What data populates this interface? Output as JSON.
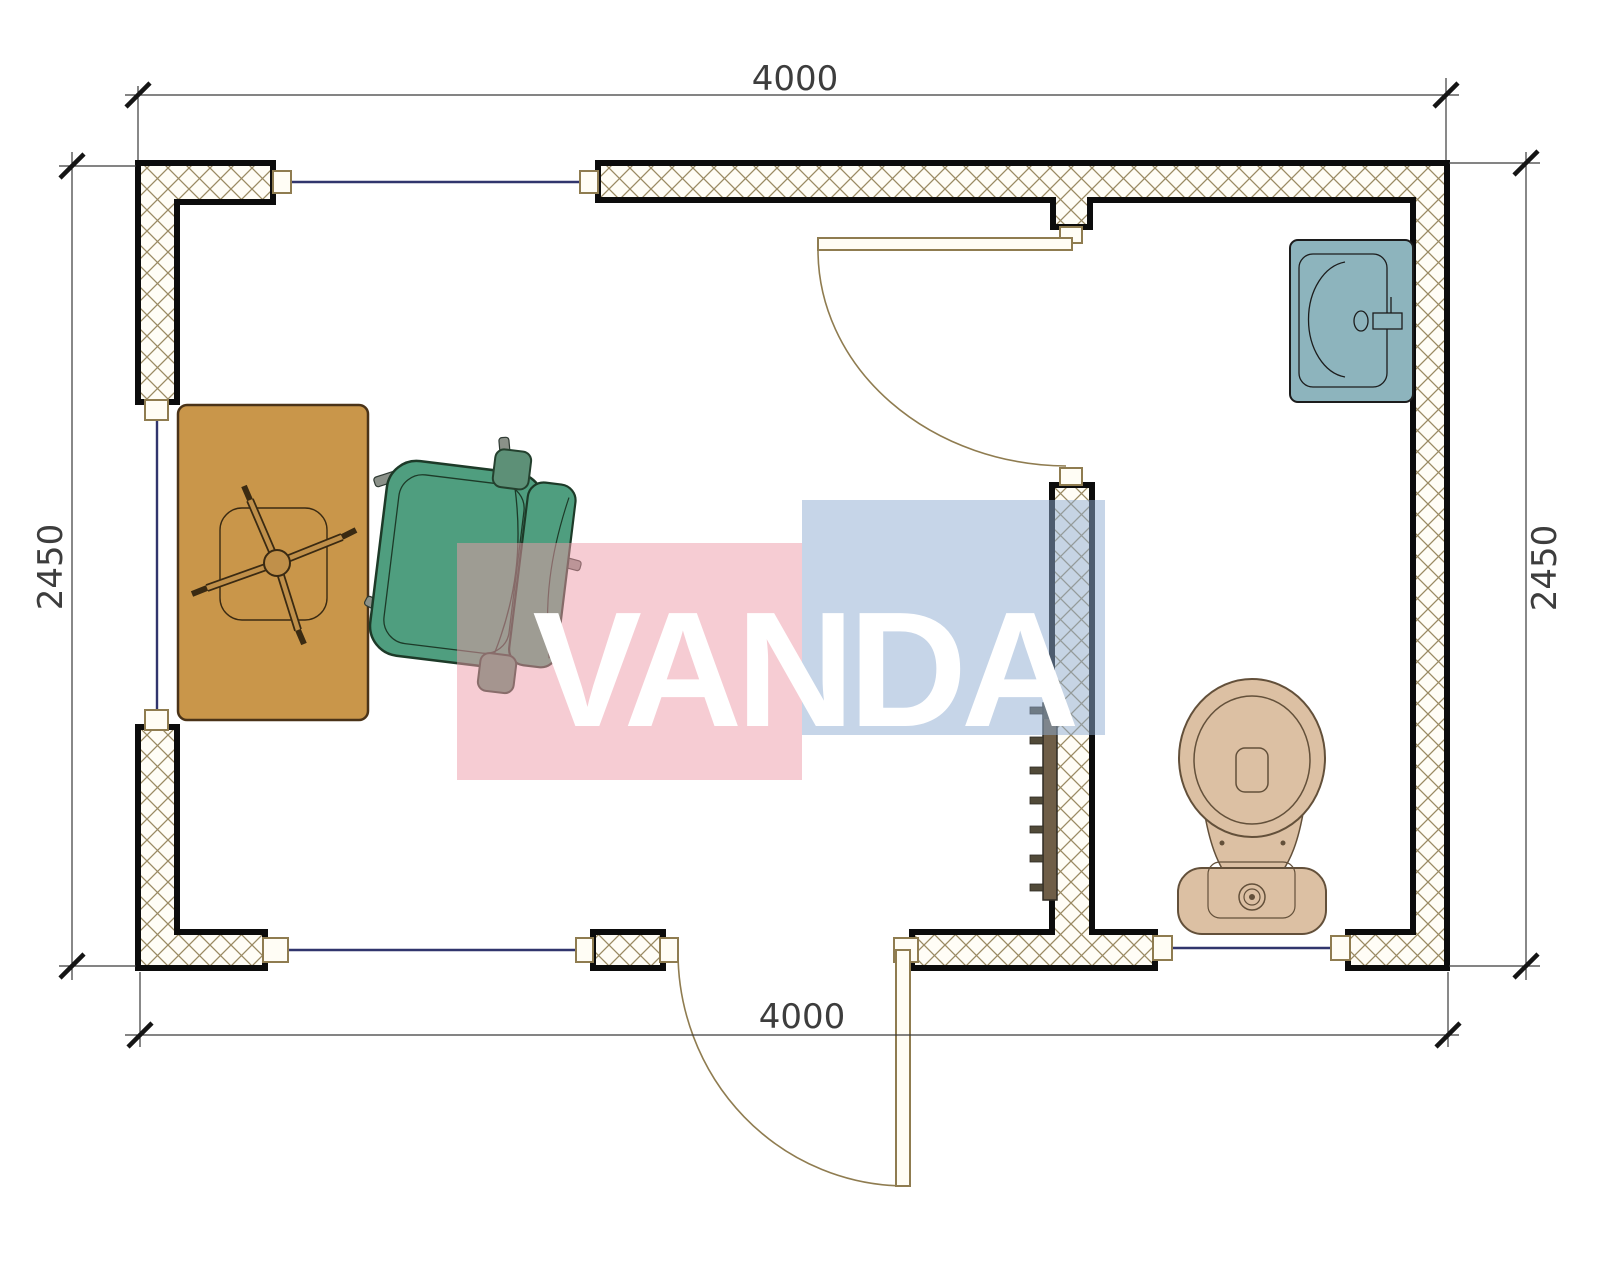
{
  "meta": {
    "type": "architectural-floor-plan",
    "view": "top-down plan of small cabin with office room and bathroom",
    "units": "mm"
  },
  "dims": {
    "top": "4000",
    "bottom": "4000",
    "left": "2450",
    "right": "2450"
  },
  "watermark": {
    "text": "VANDA",
    "pink_block": "#ed99a7",
    "blue_block": "#8dabd1",
    "letter_color": "#ffffff"
  },
  "furniture": {
    "desk": "office desk with chair star base",
    "chair": "office swivel chair",
    "sink": "bathroom wash basin",
    "toilet": "toilet with tank",
    "radiator": "wall radiator on partition"
  },
  "colors": {
    "wall_outline": "#0c0c0c",
    "wall_hatch": "#9a8a63",
    "window_line": "#31356d",
    "door_frame": "#8f7c50",
    "desk": "#c9964a",
    "chair": "#4f9e7f",
    "sink": "#8db4bd",
    "toilet": "#dcc0a3",
    "radiator": "#6f5e47",
    "dimension": "#3d3d3d"
  }
}
